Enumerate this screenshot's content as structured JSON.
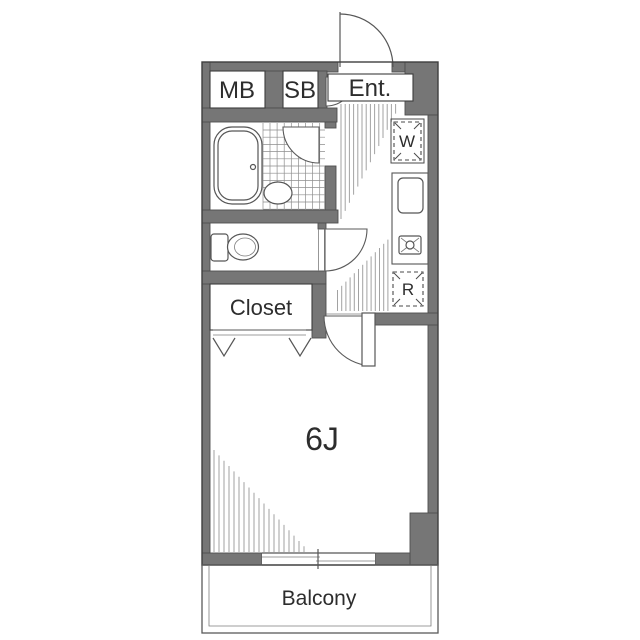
{
  "title": "One-room apartment floor plan",
  "labels": {
    "meter_box": "MB",
    "shoe_box": "SB",
    "entrance": "Ent.",
    "washer": "W",
    "refrigerator": "R",
    "closet": "Closet",
    "main_room": "6J",
    "balcony": "Balcony"
  },
  "colors": {
    "wall": "#767676",
    "wall_outline": "#4e4e4e",
    "outline": "#3f3f3f",
    "line": "#565656",
    "hatch": "#a2a2a2",
    "text": "#2d2d2d",
    "background": "#ffffff"
  }
}
